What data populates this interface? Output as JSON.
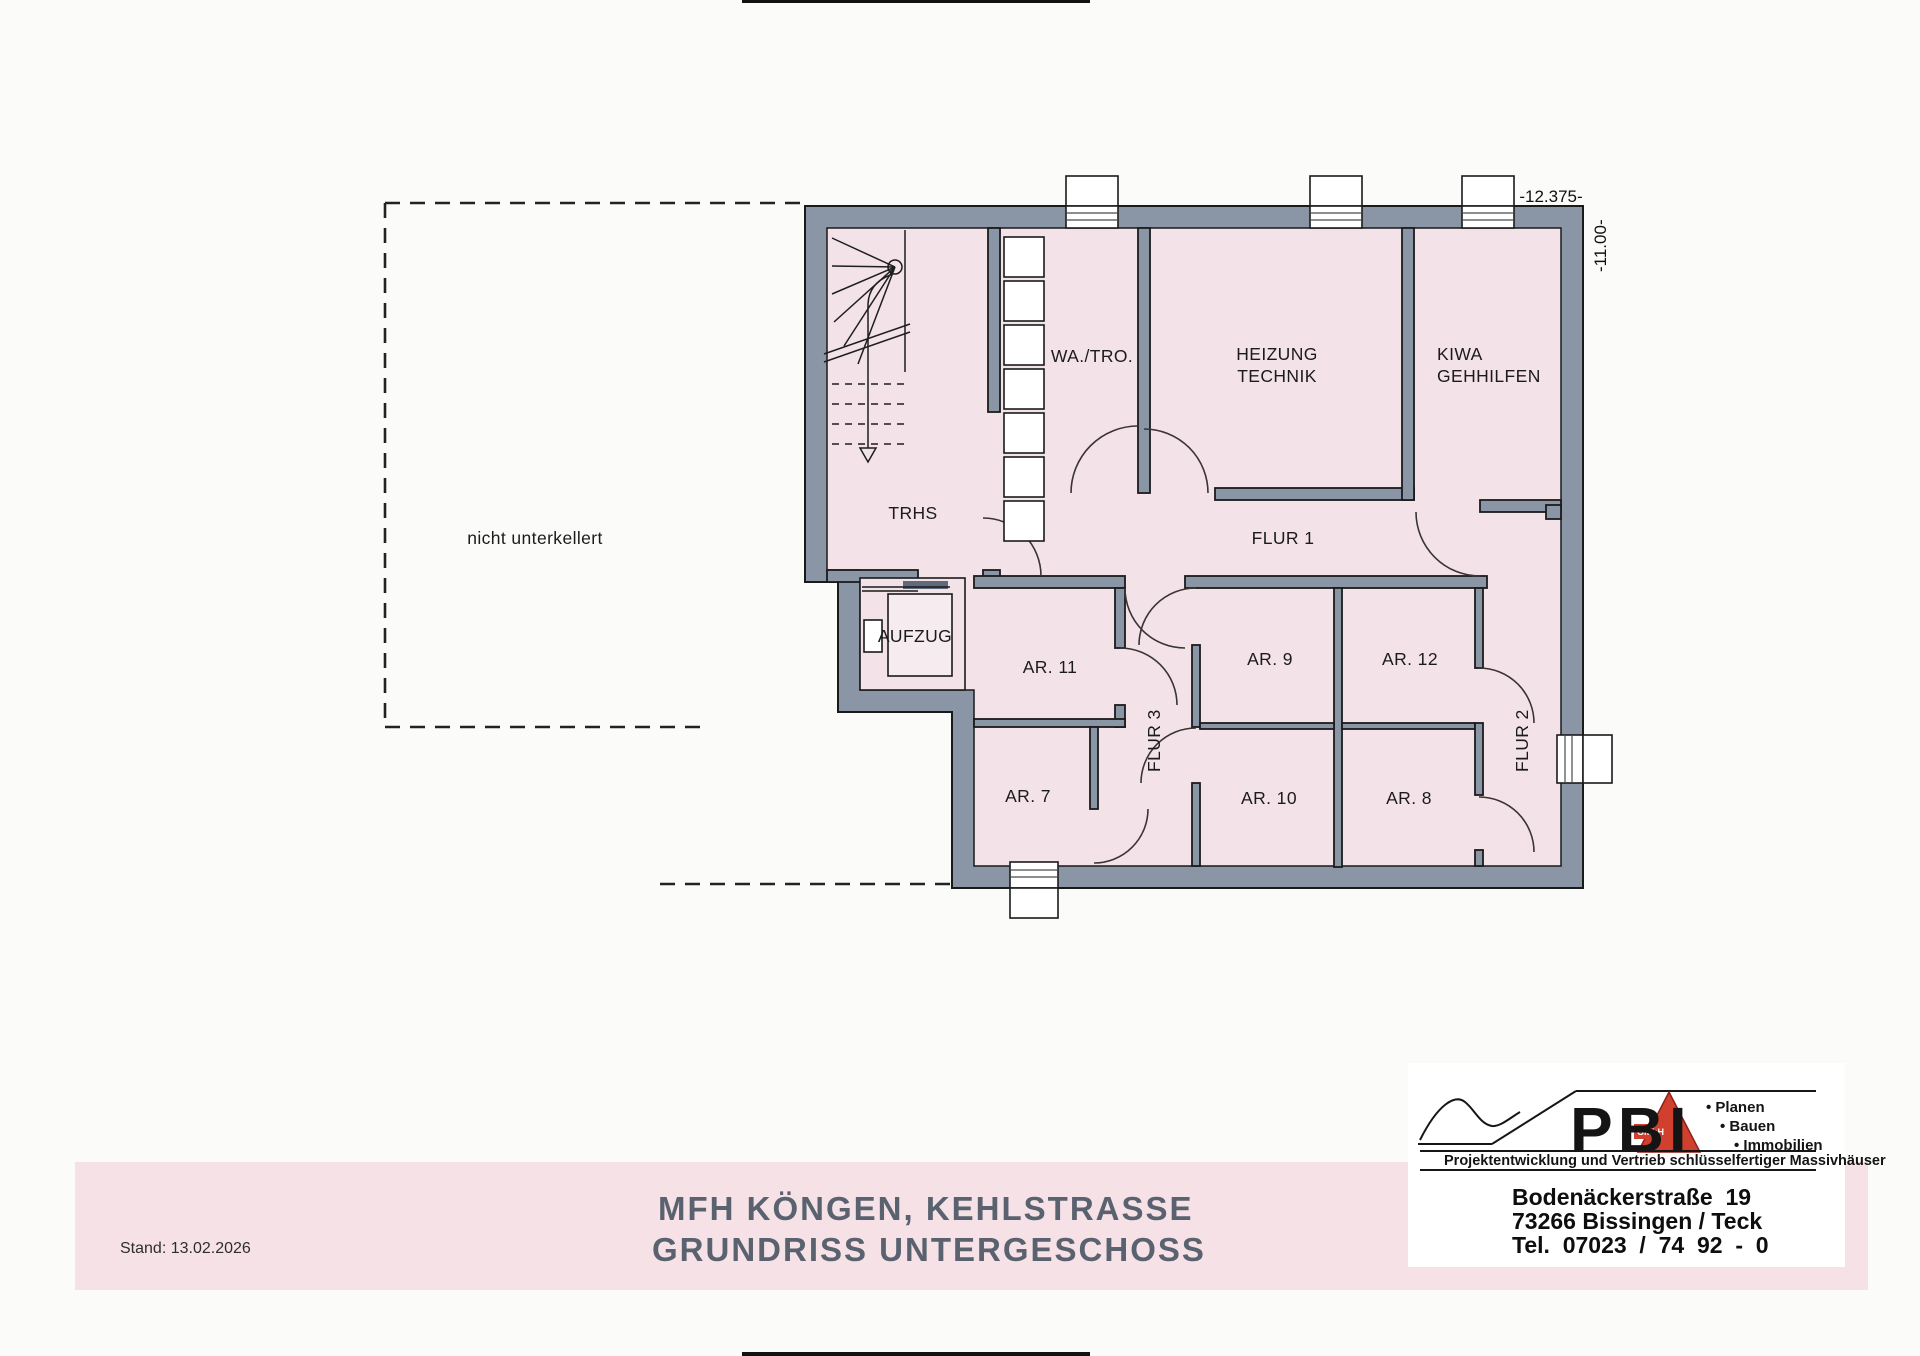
{
  "colors": {
    "wall": "#8a95a5",
    "floor": "#f3e3e8",
    "floor_light": "#f6ecef",
    "banner": "#f6e2e6",
    "accent_red": "#d1402f",
    "title": "#5a6270"
  },
  "plan": {
    "note_area": "nicht unterkellert",
    "dim_width": "-12.375-",
    "dim_height": "-11.00-",
    "rooms": {
      "trhs": "TRHS",
      "wa_tro": "WA./TRO.",
      "heizung_l1": "HEIZUNG",
      "heizung_l2": "TECHNIK",
      "kiwa_l1": "KIWA",
      "kiwa_l2": "GEHHILFEN",
      "flur1": "FLUR 1",
      "aufzug": "AUFZUG",
      "ar11": "AR. 11",
      "ar9": "AR. 9",
      "ar12": "AR. 12",
      "ar7": "AR. 7",
      "ar10": "AR. 10",
      "ar8": "AR. 8",
      "flur3": "FLUR 3",
      "flur2": "FLUR 2"
    }
  },
  "title_block": {
    "stand": "Stand: 13.02.2026",
    "line1": "MFH KÖNGEN, KEHLSTRASSE",
    "line2": "GRUNDRISS UNTERGESCHOSS",
    "scale": "M 1:100"
  },
  "logo": {
    "brand": "PBI",
    "gmbh": "GmbH",
    "bullet1": "• Planen",
    "bullet2": "• Bauen",
    "bullet3": "• Immobilien",
    "tagline": "Projektentwicklung und Vertrieb schlüsselfertiger Massivhäuser",
    "address1": "Bodenäckerstraße  19",
    "address2": "73266 Bissingen / Teck",
    "address3": "Tel.  07023  /  74  92  -  0"
  }
}
